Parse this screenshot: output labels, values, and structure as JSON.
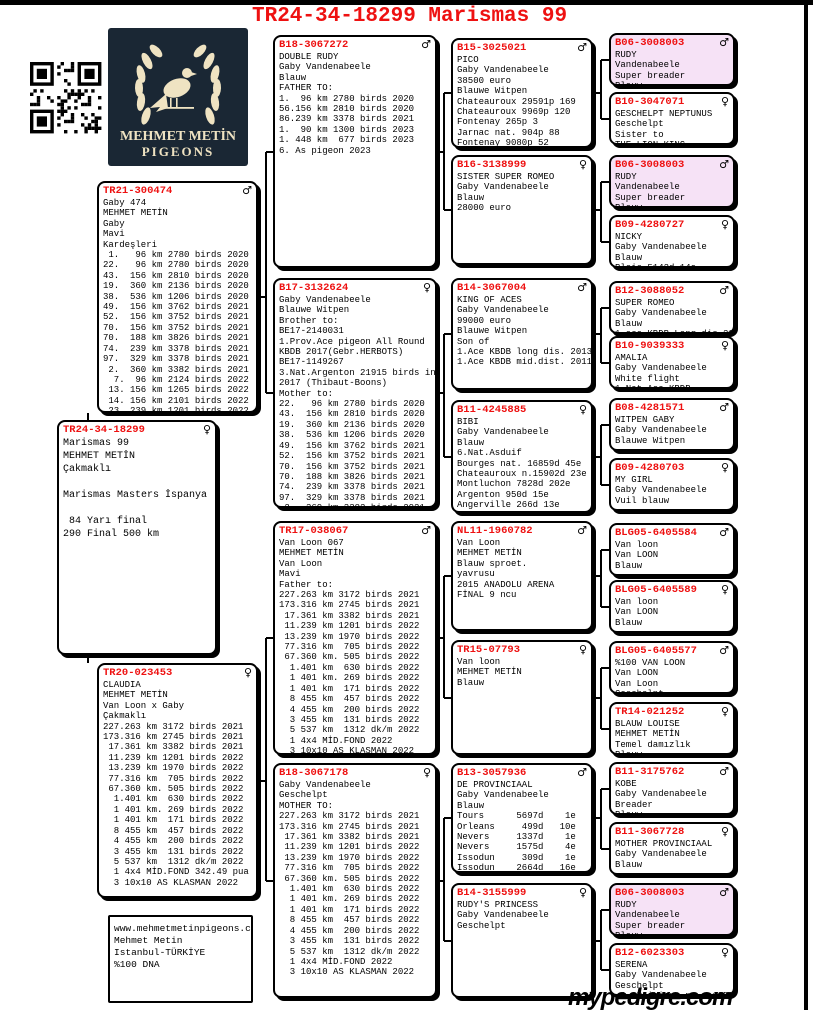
{
  "title": "TR24-34-18299 Marismas 99",
  "footer": "mypedigre.com",
  "logo": {
    "line1": "MEHMET METİN",
    "line2": "PIGEONS"
  },
  "colors": {
    "ring_red": "#ee1111",
    "pink_box": "#f6e2f6",
    "logo_navy": "#1a2734",
    "logo_cream": "#efe3c2"
  },
  "boxes": {
    "main": {
      "ring": "TR24-34-18299",
      "sex": "♀",
      "lines": [
        "Marismas 99",
        "MEHMET METİN",
        "Çakmaklı",
        "",
        "Marismas Masters İspanya",
        "",
        " 84 Yarı final",
        "290 Final 500 km"
      ]
    },
    "sire": {
      "ring": "TR21-300474",
      "sex": "♂",
      "lines": [
        "Gaby 474",
        "MEHMET METİN",
        "Gaby",
        "Mavi",
        "Kardeşleri",
        " 1.   96 km 2780 birds 2020",
        "22.   96 km 2780 birds 2020",
        "43.  156 km 2810 birds 2020",
        "19.  360 km 2136 birds 2020",
        "38.  536 km 1206 birds 2020",
        "49.  156 km 3762 birds 2021",
        "52.  156 km 3752 birds 2021",
        "70.  156 km 3752 birds 2021",
        "70.  188 km 3826 birds 2021",
        "74.  239 km 3378 birds 2021",
        "97.  329 km 3378 birds 2021",
        " 2.  360 km 3382 birds 2021",
        "  7.  96 km 2124 birds 2022",
        " 13. 156 km 1265 birds 2022",
        " 14. 156 km 2101 birds 2022",
        " 23. 239 km 1201 birds 2022"
      ]
    },
    "dam": {
      "ring": "TR20-023453",
      "sex": "♀",
      "lines": [
        "CLAUDIA",
        "MEHMET METİN",
        "Van Loon x Gaby",
        "Çakmaklı",
        "227.263 km 3172 birds 2021",
        "173.316 km 2745 birds 2021",
        " 17.361 km 3382 birds 2021",
        " 11.239 km 1201 birds 2022",
        " 13.239 km 1970 birds 2022",
        " 77.316 km  705 birds 2022",
        " 67.360 km. 505 birds 2022",
        "  1.401 km  630 birds 2022",
        "  1 401 km. 269 birds 2022",
        "  1 401 km  171 birds 2022",
        "  8 455 km  457 birds 2022",
        "  4 455 km  200 birds 2022",
        "  3 455 km  131 birds 2022",
        "  5 537 km  1312 dk/m 2022",
        "  1 4x4 MİD.FOND 342.49 pua",
        "  3 10x10 AS KLASMAN 2022"
      ]
    },
    "contact": {
      "lines": [
        "www.mehmetmetinpigeons.com",
        "Mehmet Metin",
        "Istanbul-TÜRKİYE",
        "%100 DNA"
      ]
    },
    "gp1": {
      "ring": "B18-3067272",
      "sex": "♂",
      "lines": [
        "DOUBLE RUDY",
        "Gaby Vandenabeele",
        "Blauw",
        "FATHER TO:",
        "1.  96 km 2780 birds 2020",
        "56.156 km 2810 birds 2020",
        "86.239 km 3378 birds 2021",
        "1.  90 km 1300 birds 2023",
        "1. 448 km  677 birds 2023",
        "6. As pigeon 2023"
      ]
    },
    "gp2": {
      "ring": "B17-3132624",
      "sex": "♀",
      "lines": [
        "Gaby Vandenabeele",
        "Blauwe Witpen",
        "Brother to:",
        "BE17-2140031",
        "1.Prov.Ace pigeon All Round",
        "KBDB 2017(Gebr.HERBOTS)",
        "BE17-1149267",
        "3.Nat.Argenton 21915 birds in",
        "2017 (Thibaut-Boons)",
        "Mother to:",
        "22.   96 km 2780 birds 2020",
        "43.  156 km 2810 birds 2020",
        "19.  360 km 2136 birds 2020",
        "38.  536 km 1206 birds 2020",
        "49.  156 km 3762 birds 2021",
        "52.  156 km 3752 birds 2021",
        "70.  156 km 3752 birds 2021",
        "70.  188 km 3826 birds 2021",
        "74.  239 km 3378 birds 2021",
        "97.  329 km 3378 birds 2021",
        " 2.  360 km 3382 birds 2021"
      ]
    },
    "gp3": {
      "ring": "TR17-038067",
      "sex": "♂",
      "lines": [
        "Van Loon 067",
        "MEHMET METİN",
        "Van Loon",
        "Mavi",
        "Father to:",
        "227.263 km 3172 birds 2021",
        "173.316 km 2745 birds 2021",
        " 17.361 km 3382 birds 2021",
        " 11.239 km 1201 birds 2022",
        " 13.239 km 1970 birds 2022",
        " 77.316 km  705 birds 2022",
        " 67.360 km. 505 birds 2022",
        "  1.401 km  630 birds 2022",
        "  1 401 km. 269 birds 2022",
        "  1 401 km  171 birds 2022",
        "  8 455 km  457 birds 2022",
        "  4 455 km  200 birds 2022",
        "  3 455 km  131 birds 2022",
        "  5 537 km  1312 dk/m 2022",
        "  1 4x4 MİD.FOND 2022",
        "  3 10x10 AS KLASMAN 2022"
      ]
    },
    "gp4": {
      "ring": "B18-3067178",
      "sex": "♀",
      "lines": [
        "Gaby Vandenabeele",
        "Geschelpt",
        "MOTHER TO:",
        "227.263 km 3172 birds 2021",
        "173.316 km 2745 birds 2021",
        " 17.361 km 3382 birds 2021",
        " 11.239 km 1201 birds 2022",
        " 13.239 km 1970 birds 2022",
        " 77.316 km  705 birds 2022",
        " 67.360 km. 505 birds 2022",
        "  1.401 km  630 birds 2022",
        "  1 401 km. 269 birds 2022",
        "  1 401 km  171 birds 2022",
        "  8 455 km  457 birds 2022",
        "  4 455 km  200 birds 2022",
        "  3 455 km  131 birds 2022",
        "  5 537 km  1312 dk/m 2022",
        "  1 4x4 MİD.FOND 2022",
        "  3 10x10 AS KLASMAN 2022"
      ]
    },
    "ggp1": {
      "ring": "B15-3025021",
      "sex": "♂",
      "lines": [
        "PICO",
        "Gaby Vandenabeele",
        "38500 euro",
        "Blauwe Witpen",
        "Chateauroux 29591p 169",
        "Chateauroux 9969p 120",
        "Fontenay 265p 3",
        "Jarnac nat. 904p 88",
        "Fontenay 9080p 52",
        "Jarnac nat. 4400p 92"
      ]
    },
    "ggp2": {
      "ring": "B16-3138999",
      "sex": "♀",
      "lines": [
        "SISTER SUPER ROMEO",
        "Gaby Vandenabeele",
        "Blauw",
        "28000 euro"
      ]
    },
    "ggp3": {
      "ring": "B14-3067004",
      "sex": "♂",
      "lines": [
        "KING OF ACES",
        "Gaby Vandenabeele",
        "99000 euro",
        "Blauwe Witpen",
        "Son of",
        "1.Ace KBDB long dis. 2013",
        "1.Ace KBDB mid.dist. 2011"
      ]
    },
    "ggp4": {
      "ring": "B11-4245885",
      "sex": "♀",
      "lines": [
        "BIBI",
        "Gaby Vandenabeele",
        "Blauw",
        "6.Nat.Asduif",
        "Bourges nat. 16859d 45e",
        "Chateauroux n.15902d 23e",
        "Montluchon 7828d 202e",
        "Argenton 950d 15e",
        "Angerville 266d 13e"
      ]
    },
    "ggp5": {
      "ring": "NL11-1960782",
      "sex": "♂",
      "lines": [
        "Van Loon",
        "MEHMET METİN",
        "Blauw sproet.",
        "yavrusu",
        "2015 ANADOLU ARENA",
        "FİNAL 9 ncu"
      ]
    },
    "ggp6": {
      "ring": "TR15-07793",
      "sex": "♀",
      "lines": [
        "Van loon",
        "MEHMET METİN",
        "Blauw"
      ]
    },
    "ggp7": {
      "ring": "B13-3057936",
      "sex": "♂",
      "lines": [
        "DE PROVINCIAAL",
        "Gaby Vandenabeele",
        "Blauw",
        "Tours      5697d    1e",
        "Orleans     499d   10e",
        "Nevers     1337d    1e",
        "Nevers     1575d    4e",
        "Issodun     309d    1e",
        "Issodun    2664d   16e",
        "Tulle       900d    2e"
      ]
    },
    "ggp8": {
      "ring": "B14-3155999",
      "sex": "♀",
      "lines": [
        "RUDY'S PRINCESS",
        "Gaby Vandenabeele",
        "Geschelpt"
      ]
    },
    "g1": {
      "ring": "B06-3008003",
      "sex": "♂",
      "pink": true,
      "lines": [
        "RUDY",
        "Vandenabeele",
        "Super breader",
        "Blauw"
      ]
    },
    "g2": {
      "ring": "B10-3047071",
      "sex": "♀",
      "lines": [
        "GESCHELPT NEPTUNUS",
        "Geschelpt",
        "Sister to",
        "THE LION KING"
      ]
    },
    "g3": {
      "ring": "B06-3008003",
      "sex": "♂",
      "pink": true,
      "lines": [
        "RUDY",
        "Vandenabeele",
        "Super breader",
        "Blauw"
      ]
    },
    "g4": {
      "ring": "B09-4280727",
      "sex": "♀",
      "lines": [
        "NICKY",
        "Gaby Vandenabeele",
        "Blauw",
        "Blois 5142d 14e"
      ]
    },
    "g5": {
      "ring": "B12-3088052",
      "sex": "♂",
      "lines": [
        "SUPER ROMEO",
        "Gaby Vandenabeele",
        "Blauw",
        "1.ace KBDB Long dis.2013"
      ]
    },
    "g6": {
      "ring": "B10-9039333",
      "sex": "♀",
      "lines": [
        "AMALIA",
        "Gaby Vandenabeele",
        "White flight",
        "1.Nat.Ace KBDB"
      ]
    },
    "g7": {
      "ring": "B08-4281571",
      "sex": "♂",
      "lines": [
        "WITPEN GABY",
        "Gaby Vandenabeele",
        "Blauwe Witpen"
      ]
    },
    "g8": {
      "ring": "B09-4280703",
      "sex": "♀",
      "lines": [
        "MY GIRL",
        "Gaby Vandenabeele",
        "Vuil blauw"
      ]
    },
    "g9": {
      "ring": "BLG05-6405584",
      "sex": "♂",
      "lines": [
        "Van loon",
        "Van LOON",
        "Blauw"
      ]
    },
    "g10": {
      "ring": "BLG05-6405589",
      "sex": "♀",
      "lines": [
        "Van loon",
        "Van LOON",
        "Blauw"
      ]
    },
    "g11": {
      "ring": "BLG05-6405577",
      "sex": "♂",
      "lines": [
        "%100 VAN LOON",
        "Van LOON",
        "Van Loon",
        "Geschelpt"
      ]
    },
    "g12": {
      "ring": "TR14-021252",
      "sex": "♀",
      "lines": [
        "BLAUW LOUISE",
        "MEHMET METİN",
        "Temel damızlık",
        "Blauw"
      ]
    },
    "g13": {
      "ring": "B11-3175762",
      "sex": "♂",
      "lines": [
        "KOBE",
        "Gaby Vandenabeele",
        "Breader",
        "Blauw"
      ]
    },
    "g14": {
      "ring": "B11-3067728",
      "sex": "♀",
      "lines": [
        "MOTHER PROVINCIAAL",
        "Gaby Vandenabeele",
        "Blauw"
      ]
    },
    "g15": {
      "ring": "B06-3008003",
      "sex": "♂",
      "pink": true,
      "lines": [
        "RUDY",
        "Vandenabeele",
        "Super breader",
        "Blauw"
      ]
    },
    "g16": {
      "ring": "B12-6023303",
      "sex": "♀",
      "lines": [
        "SERENA",
        "Gaby Vandenabeele",
        "Geschelpt",
        " 1. Poitiers pr.  1952d"
      ]
    }
  }
}
